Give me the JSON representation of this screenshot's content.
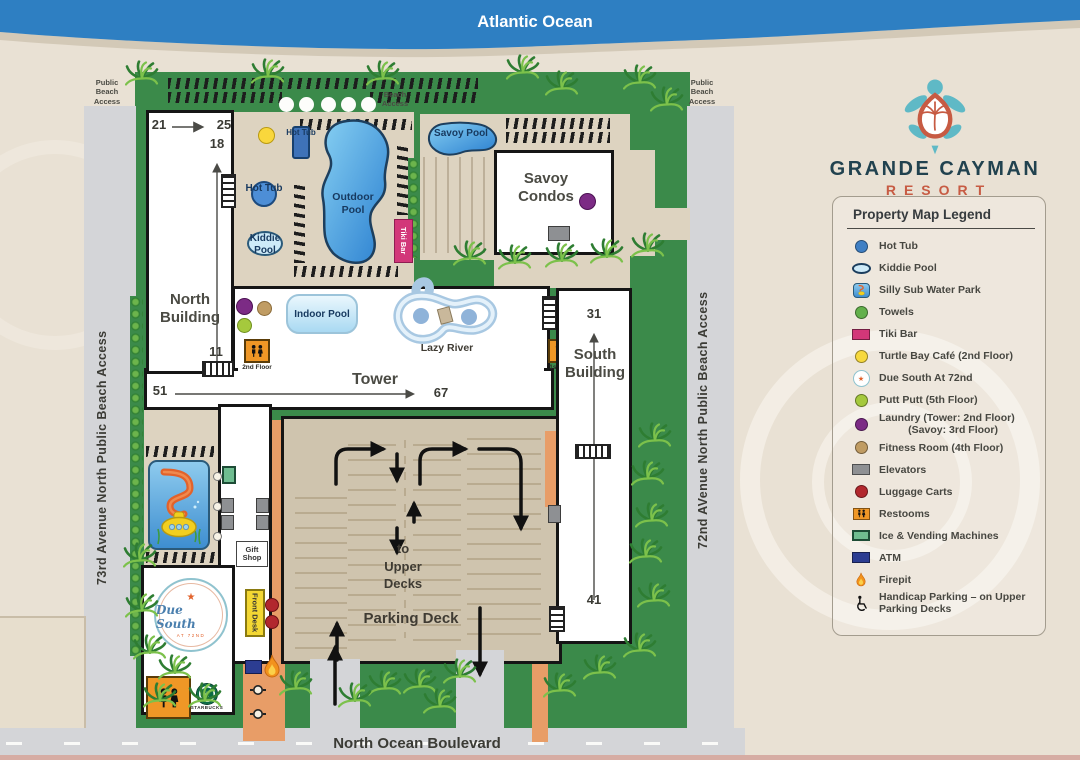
{
  "ocean": {
    "label": "Atlantic Ocean"
  },
  "brand": {
    "name": "GRANDE CAYMAN",
    "tagline": "RESORT"
  },
  "legend": {
    "title": "Property Map Legend",
    "items": [
      {
        "name": "hot-tub",
        "icon": "circle",
        "color": "#3f7fc4",
        "label": "Hot Tub"
      },
      {
        "name": "kiddie-pool",
        "icon": "oval",
        "color": "#cdeaf8",
        "label": "Kiddie Pool"
      },
      {
        "name": "silly-sub",
        "icon": "silly-sub",
        "color": "#f2cf1f",
        "label": "Silly Sub Water Park"
      },
      {
        "name": "towels",
        "icon": "circle",
        "color": "#63b04b",
        "label": "Towels"
      },
      {
        "name": "tiki-bar",
        "icon": "rect",
        "color": "#d23779",
        "label": "Tiki Bar"
      },
      {
        "name": "turtle-bay-cafe",
        "icon": "circle",
        "color": "#f7d93e",
        "label": "Turtle Bay Café (2nd Floor)"
      },
      {
        "name": "due-south",
        "icon": "due-south",
        "color": "#e2622b",
        "label": "Due South At 72nd"
      },
      {
        "name": "putt-putt",
        "icon": "circle",
        "color": "#a5c93d",
        "label": "Putt Putt (5th Floor)"
      },
      {
        "name": "laundry",
        "icon": "circle",
        "color": "#7c2b85",
        "label": "Laundry (Tower: 2nd Floor)\n          (Savoy: 3rd Floor)"
      },
      {
        "name": "fitness-room",
        "icon": "circle",
        "color": "#c09c63",
        "label": "Fitness Room (4th Floor)"
      },
      {
        "name": "elevators",
        "icon": "rect",
        "color": "#8e9093",
        "label": "Elevators"
      },
      {
        "name": "luggage-carts",
        "icon": "circle",
        "color": "#b2282e",
        "label": "Luggage Carts"
      },
      {
        "name": "restrooms",
        "icon": "restroom",
        "color": "#ef9726",
        "label": "Restooms"
      },
      {
        "name": "ice-vending",
        "icon": "rect-border",
        "color": "#6fbd90",
        "label": "Ice & Vending Machines"
      },
      {
        "name": "atm",
        "icon": "rect",
        "color": "#2c3d92",
        "label": "ATM"
      },
      {
        "name": "firepit",
        "icon": "flame",
        "color": "#f2921d",
        "label": "Firepit"
      },
      {
        "name": "handicap-parking",
        "icon": "wheelchair",
        "color": "#111111",
        "label": "Handicap Parking – on Upper\nParking Decks"
      }
    ]
  },
  "roads": {
    "left_street": "73rd Avenue North Public Beach Access",
    "right_street": "72nd AVenue North Public Beach Access",
    "bottom_street": "North Ocean Boulevard"
  },
  "access": {
    "top_left": "Public Beach Access",
    "top_center": "Beach Access",
    "top_right": "Public Beach Access"
  },
  "buildings": {
    "north": "North Building",
    "tower": "Tower",
    "south": "South Building",
    "savoy": "Savoy Condos"
  },
  "features": {
    "outdoor_pool": "Outdoor Pool",
    "indoor_pool": "Indoor Pool",
    "savoy_pool": "Savoy Pool",
    "kiddie_pool": "Kiddie Pool",
    "hot_tub_upper": "Hot Tub",
    "hot_tub_lower": "Hot Tub",
    "lazy_river": "Lazy River",
    "tiki_bar": "Tiki Bar",
    "gift_shop": "Gift Shop",
    "front_desk": "Front Desk",
    "to_upper_decks": "to Upper Decks",
    "parking_deck": "Parking Deck",
    "restroom_tower_floor": "2nd Floor",
    "restroom_south_floor": "1st Floor",
    "starbucks": "STARBUCKS",
    "due_south_name": "Due South",
    "due_south_sub": "AT 72ND"
  },
  "room_numbers": {
    "north_start": "21",
    "north_end": "25",
    "north_mid": "18",
    "north_low": "11",
    "tower_start": "51",
    "tower_end": "67",
    "south_start": "31",
    "south_end": "41"
  },
  "colors": {
    "ocean": "#2e7fc2",
    "grass": "#3b8a4a",
    "road": "#d4d5d8",
    "deck_tan": "#d0c5ae",
    "walkway_orange": "#e89d67",
    "brand_navy": "#21424f",
    "brand_orange": "#c75b43"
  }
}
